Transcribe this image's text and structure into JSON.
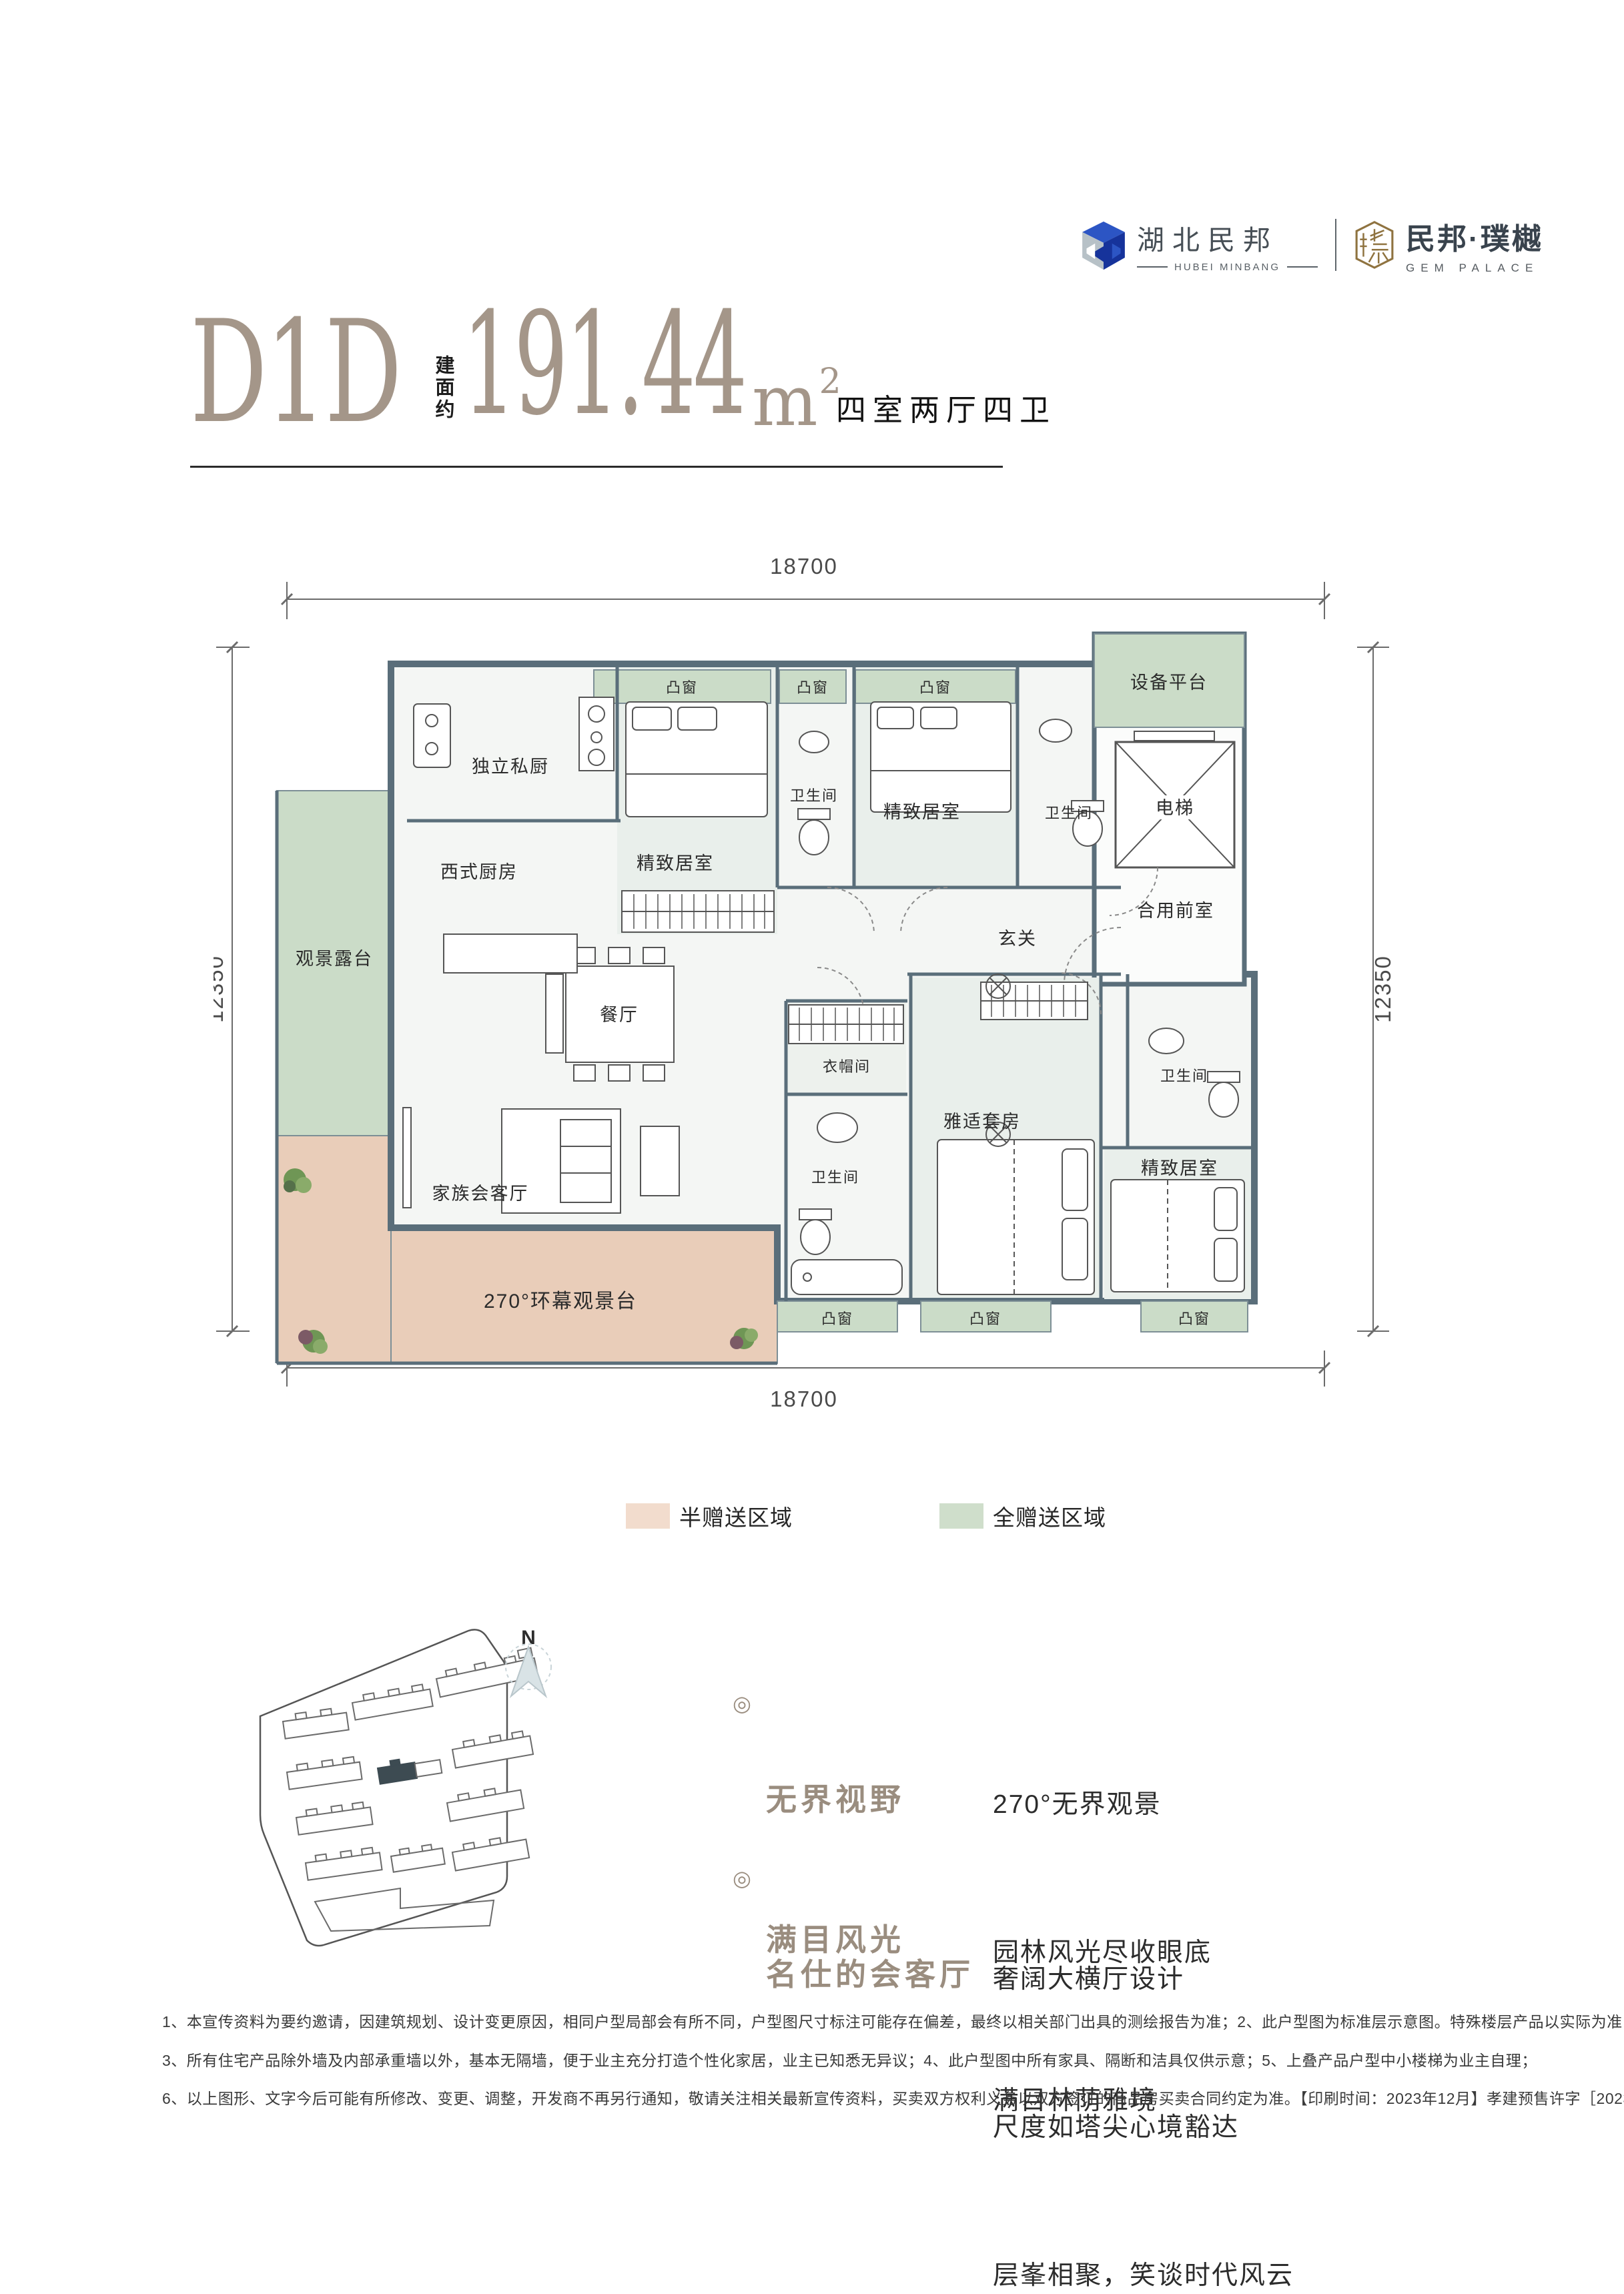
{
  "header": {
    "minbang": {
      "cn": "湖北民邦",
      "en": "HUBEI MINBANG"
    },
    "gem": {
      "cn": "民邦·璞樾",
      "en": "GEM PALACE"
    }
  },
  "title": {
    "code": "D1D",
    "area_label": "建面约",
    "area_value": "191.44",
    "unit": "m",
    "unit_sup": "2",
    "layout": "四室两厅四卫"
  },
  "plan": {
    "dims": {
      "top": "18700",
      "bottom": "18700",
      "left": "12350",
      "right": "12350"
    },
    "rooms": {
      "private_kitchen": "独立私厨",
      "western_kitchen": "西式厨房",
      "view_terrace": "观景露台",
      "dining": "餐厅",
      "family_living": "家族会客厅",
      "wrap_terrace": "270°环幕观景台",
      "fine_bedroom": "精致居室",
      "bathroom": "卫生间",
      "bay_window": "凸窗",
      "equipment_platform": "设备平台",
      "elevator": "电梯",
      "foyer": "玄关",
      "shared_front_room": "合用前室",
      "cloakroom": "衣帽间",
      "suite": "雅适套房"
    }
  },
  "legend": {
    "half": {
      "label": "半赠送区域",
      "color": "#f2dccd"
    },
    "full": {
      "label": "全赠送区域",
      "color": "#cfdecb"
    }
  },
  "sitemap": {
    "north": "N"
  },
  "features": [
    {
      "marker": "◎",
      "title_lines": [
        "无界视野",
        "满目风光"
      ],
      "lines": [
        "270°无界观景",
        "园林风光尽收眼底",
        "满目林荫雅境"
      ]
    },
    {
      "marker": "◎",
      "title_lines": [
        "名仕的会客厅"
      ],
      "lines": [
        "奢阔大横厅设计",
        "尺度如塔尖心境豁达",
        "层峯相聚，笑谈时代风云"
      ]
    }
  ],
  "disclaimer": [
    "1、本宣传资料为要约邀请，因建筑规划、设计变更原因，相同户型局部会有所不同，户型图尺寸标注可能存在偏差，最终以相关部门出具的测绘报告为准；2、此户型图为标准层示意图。特殊楼层产品以实际为准；",
    "3、所有住宅产品除外墙及内部承重墙以外，基本无隔墙，便于业主充分打造个性化家居，业主已知悉无异议；4、此户型图中所有家具、隔断和洁具仅供示意；5、上叠产品户型中小楼梯为业主自理；",
    "6、以上图形、文字今后可能有所修改、变更、调整，开发商不再另行通知，敬请关注相关最新宣传资料，买卖双方权利义务以双方签订的商品房买卖合同约定为准。【印刷时间：2023年12月】孝建预售许字［2023］0043号"
  ],
  "colors": {
    "wall": "#5a6e7a",
    "full_gift": "#cbdcc8",
    "half_gift": "#e9cdb9",
    "title": "#a49689"
  }
}
